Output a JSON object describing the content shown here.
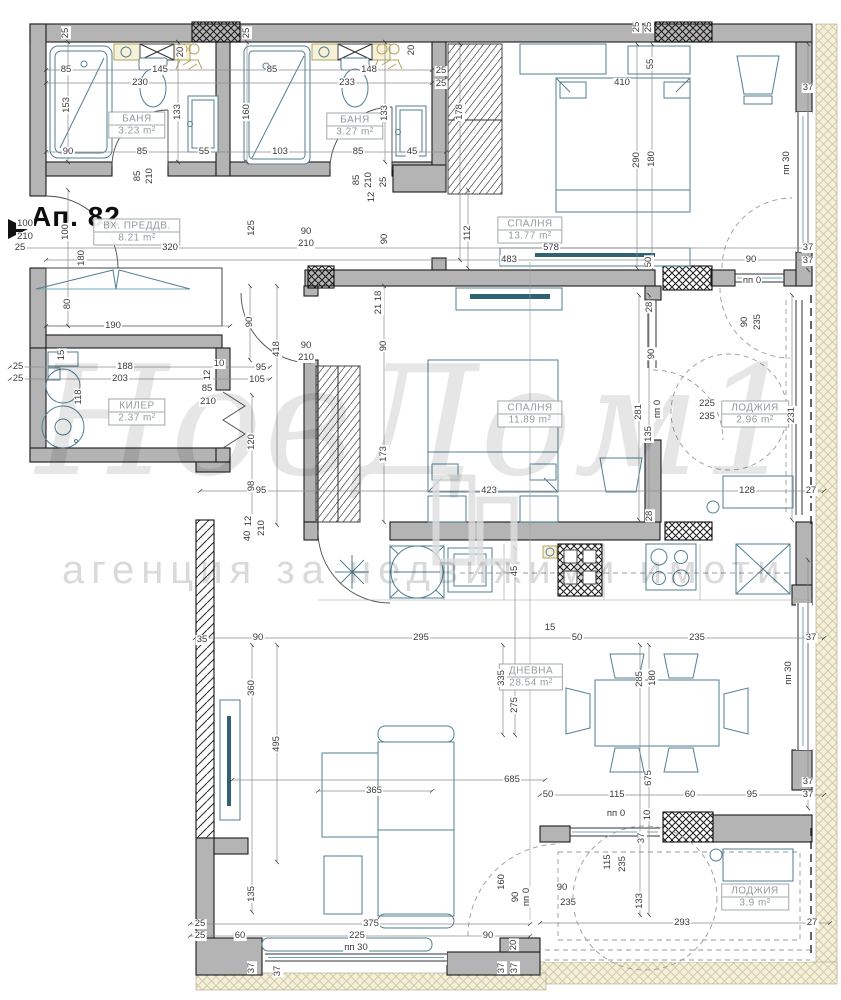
{
  "title": "Ап. 82",
  "watermark": {
    "line1": "НовДом1",
    "line2": "агенция за недвижими имоти"
  },
  "rooms": [
    {
      "name": "БАНЯ",
      "area": "3.23 m²",
      "x": 137,
      "y": 125
    },
    {
      "name": "БАНЯ",
      "area": "3.27 m²",
      "x": 355,
      "y": 126
    },
    {
      "name": "ВХ. ПРЕДДВ.",
      "area": "8.21 m²",
      "x": 137,
      "y": 232
    },
    {
      "name": "СПАЛНЯ",
      "area": "13.77 m²",
      "x": 530,
      "y": 230
    },
    {
      "name": "СПАЛНЯ",
      "area": "11.89 m²",
      "x": 530,
      "y": 414
    },
    {
      "name": "КИЛЕР",
      "area": "2.37 m²",
      "x": 137,
      "y": 412
    },
    {
      "name": "ЛОДЖИЯ",
      "area": "2.96 m²",
      "x": 755,
      "y": 414
    },
    {
      "name": "ДНЕВНА",
      "area": "28.54 m²",
      "x": 531,
      "y": 677
    },
    {
      "name": "ЛОДЖИЯ",
      "area": "3.9 m²",
      "x": 755,
      "y": 897
    }
  ],
  "dims": [
    {
      "t": "25",
      "x": 66,
      "y": 33,
      "r": 90
    },
    {
      "t": "20",
      "x": 181,
      "y": 52,
      "r": 90
    },
    {
      "t": "25",
      "x": 247,
      "y": 33,
      "r": 90
    },
    {
      "t": "20",
      "x": 412,
      "y": 50,
      "r": 90
    },
    {
      "t": "25",
      "x": 637,
      "y": 27,
      "r": 90
    },
    {
      "t": "25",
      "x": 649,
      "y": 27,
      "r": 90
    },
    {
      "t": "85",
      "x": 66,
      "y": 70,
      "r": 0
    },
    {
      "t": "145",
      "x": 160,
      "y": 70,
      "r": 0
    },
    {
      "t": "85",
      "x": 272,
      "y": 70,
      "r": 0
    },
    {
      "t": "148",
      "x": 369,
      "y": 70,
      "r": 0
    },
    {
      "t": "25",
      "x": 441,
      "y": 71,
      "r": 0
    },
    {
      "t": "25",
      "x": 441,
      "y": 84,
      "r": 0
    },
    {
      "t": "230",
      "x": 140,
      "y": 83,
      "r": 0
    },
    {
      "t": "233",
      "x": 347,
      "y": 83,
      "r": 0
    },
    {
      "t": "153",
      "x": 67,
      "y": 105,
      "r": 90
    },
    {
      "t": "133",
      "x": 178,
      "y": 112,
      "r": 90
    },
    {
      "t": "160",
      "x": 247,
      "y": 112,
      "r": 90
    },
    {
      "t": "133",
      "x": 385,
      "y": 113,
      "r": 90
    },
    {
      "t": "178",
      "x": 460,
      "y": 112,
      "r": 90
    },
    {
      "t": "90",
      "x": 68,
      "y": 152,
      "r": 0
    },
    {
      "t": "85",
      "x": 142,
      "y": 152,
      "r": 0
    },
    {
      "t": "55",
      "x": 204,
      "y": 152,
      "r": 0
    },
    {
      "t": "103",
      "x": 280,
      "y": 152,
      "r": 0
    },
    {
      "t": "85",
      "x": 358,
      "y": 152,
      "r": 0
    },
    {
      "t": "45",
      "x": 412,
      "y": 152,
      "r": 0
    },
    {
      "t": "85",
      "x": 138,
      "y": 176,
      "r": 90
    },
    {
      "t": "210",
      "x": 150,
      "y": 176,
      "r": 90
    },
    {
      "t": "85",
      "x": 357,
      "y": 180,
      "r": 90
    },
    {
      "t": "210",
      "x": 369,
      "y": 180,
      "r": 90
    },
    {
      "t": "25",
      "x": 384,
      "y": 182,
      "r": 90
    },
    {
      "t": "12",
      "x": 372,
      "y": 197,
      "r": 90
    },
    {
      "t": "410",
      "x": 622,
      "y": 83,
      "r": 0
    },
    {
      "t": "55",
      "x": 651,
      "y": 64,
      "r": 90
    },
    {
      "t": "290",
      "x": 637,
      "y": 160,
      "r": 90
    },
    {
      "t": "180",
      "x": 652,
      "y": 159,
      "r": 90
    },
    {
      "t": "112",
      "x": 468,
      "y": 233,
      "r": 90
    },
    {
      "t": "578",
      "x": 551,
      "y": 248,
      "r": 0
    },
    {
      "t": "483",
      "x": 509,
      "y": 260,
      "r": 0
    },
    {
      "t": "90",
      "x": 751,
      "y": 260,
      "r": 0
    },
    {
      "t": "37",
      "x": 808,
      "y": 88,
      "r": 0
    },
    {
      "t": "37",
      "x": 808,
      "y": 248,
      "r": 0
    },
    {
      "t": "37",
      "x": 808,
      "y": 261,
      "r": 0
    },
    {
      "t": "пп 30",
      "x": 787,
      "y": 163,
      "r": 90
    },
    {
      "t": "пп 0",
      "x": 752,
      "y": 281,
      "r": 0
    },
    {
      "t": "100",
      "x": 25,
      "y": 224,
      "r": 0
    },
    {
      "t": "210",
      "x": 25,
      "y": 237,
      "r": 0
    },
    {
      "t": "25",
      "x": 20,
      "y": 248,
      "r": 0
    },
    {
      "t": "100",
      "x": 66,
      "y": 232,
      "r": 90
    },
    {
      "t": "180",
      "x": 82,
      "y": 258,
      "r": 90
    },
    {
      "t": "320",
      "x": 170,
      "y": 248,
      "r": 0
    },
    {
      "t": "125",
      "x": 252,
      "y": 228,
      "r": 90
    },
    {
      "t": "90",
      "x": 306,
      "y": 232,
      "r": 0
    },
    {
      "t": "210",
      "x": 306,
      "y": 244,
      "r": 0
    },
    {
      "t": "90",
      "x": 385,
      "y": 239,
      "r": 90
    },
    {
      "t": "18",
      "x": 379,
      "y": 296,
      "r": 90
    },
    {
      "t": "21",
      "x": 379,
      "y": 309,
      "r": 90
    },
    {
      "t": "80",
      "x": 68,
      "y": 304,
      "r": 90
    },
    {
      "t": "190",
      "x": 113,
      "y": 326,
      "r": 0
    },
    {
      "t": "90",
      "x": 250,
      "y": 322,
      "r": 90
    },
    {
      "t": "15",
      "x": 62,
      "y": 355,
      "r": 90
    },
    {
      "t": "25",
      "x": 18,
      "y": 367,
      "r": 0
    },
    {
      "t": "188",
      "x": 125,
      "y": 367,
      "r": 0
    },
    {
      "t": "95",
      "x": 261,
      "y": 368,
      "r": 0
    },
    {
      "t": "25",
      "x": 18,
      "y": 379,
      "r": 0
    },
    {
      "t": "203",
      "x": 120,
      "y": 379,
      "r": 0
    },
    {
      "t": "105",
      "x": 257,
      "y": 380,
      "r": 0
    },
    {
      "t": "118",
      "x": 79,
      "y": 397,
      "r": 90
    },
    {
      "t": "10",
      "x": 219,
      "y": 364,
      "r": 0
    },
    {
      "t": "12",
      "x": 208,
      "y": 375,
      "r": 90
    },
    {
      "t": "85",
      "x": 207,
      "y": 389,
      "r": 0
    },
    {
      "t": "210",
      "x": 208,
      "y": 402,
      "r": 0
    },
    {
      "t": "418",
      "x": 277,
      "y": 349,
      "r": 90
    },
    {
      "t": "90",
      "x": 306,
      "y": 346,
      "r": 0
    },
    {
      "t": "210",
      "x": 306,
      "y": 358,
      "r": 0
    },
    {
      "t": "90",
      "x": 384,
      "y": 346,
      "r": 90
    },
    {
      "t": "173",
      "x": 384,
      "y": 454,
      "r": 90
    },
    {
      "t": "120",
      "x": 252,
      "y": 442,
      "r": 90
    },
    {
      "t": "98",
      "x": 252,
      "y": 486,
      "r": 90
    },
    {
      "t": "95",
      "x": 261,
      "y": 491,
      "r": 0
    },
    {
      "t": "12",
      "x": 249,
      "y": 521,
      "r": 90
    },
    {
      "t": "210",
      "x": 262,
      "y": 528,
      "r": 90
    },
    {
      "t": "40",
      "x": 248,
      "y": 536,
      "r": 90
    },
    {
      "t": "423",
      "x": 489,
      "y": 491,
      "r": 0
    },
    {
      "t": "128",
      "x": 747,
      "y": 491,
      "r": 0
    },
    {
      "t": "27",
      "x": 811,
      "y": 491,
      "r": 0
    },
    {
      "t": "281",
      "x": 639,
      "y": 412,
      "r": 90
    },
    {
      "t": "пп 0",
      "x": 658,
      "y": 409,
      "r": 90
    },
    {
      "t": "225",
      "x": 707,
      "y": 404,
      "r": 0
    },
    {
      "t": "235",
      "x": 707,
      "y": 417,
      "r": 0
    },
    {
      "t": "135",
      "x": 649,
      "y": 434,
      "r": 90
    },
    {
      "t": "231",
      "x": 792,
      "y": 415,
      "r": 90
    },
    {
      "t": "28",
      "x": 650,
      "y": 307,
      "r": 90
    },
    {
      "t": "90",
      "x": 652,
      "y": 354,
      "r": 90
    },
    {
      "t": "50",
      "x": 649,
      "y": 262,
      "r": 90
    },
    {
      "t": "90",
      "x": 745,
      "y": 322,
      "r": 90
    },
    {
      "t": "235",
      "x": 758,
      "y": 322,
      "r": 90
    },
    {
      "t": "28",
      "x": 650,
      "y": 516,
      "r": 90
    },
    {
      "t": "45",
      "x": 515,
      "y": 571,
      "r": 90
    },
    {
      "t": "15",
      "x": 550,
      "y": 628,
      "r": 0
    },
    {
      "t": "50",
      "x": 577,
      "y": 638,
      "r": 0
    },
    {
      "t": "295",
      "x": 421,
      "y": 638,
      "r": 0
    },
    {
      "t": "235",
      "x": 697,
      "y": 638,
      "r": 0
    },
    {
      "t": "37",
      "x": 811,
      "y": 638,
      "r": 0
    },
    {
      "t": "90",
      "x": 258,
      "y": 638,
      "r": 0
    },
    {
      "t": "35",
      "x": 202,
      "y": 640,
      "r": 0
    },
    {
      "t": "360",
      "x": 252,
      "y": 688,
      "r": 90
    },
    {
      "t": "495",
      "x": 277,
      "y": 744,
      "r": 90
    },
    {
      "t": "135",
      "x": 252,
      "y": 894,
      "r": 90
    },
    {
      "t": "335",
      "x": 502,
      "y": 678,
      "r": 90
    },
    {
      "t": "275",
      "x": 515,
      "y": 705,
      "r": 90
    },
    {
      "t": "285",
      "x": 640,
      "y": 679,
      "r": 90
    },
    {
      "t": "180",
      "x": 653,
      "y": 678,
      "r": 90
    },
    {
      "t": "пп 30",
      "x": 789,
      "y": 673,
      "r": 90
    },
    {
      "t": "685",
      "x": 512,
      "y": 780,
      "r": 0
    },
    {
      "t": "365",
      "x": 374,
      "y": 791,
      "r": 0
    },
    {
      "t": "675",
      "x": 649,
      "y": 778,
      "r": 90
    },
    {
      "t": "50",
      "x": 548,
      "y": 795,
      "r": 0
    },
    {
      "t": "115",
      "x": 617,
      "y": 795,
      "r": 0
    },
    {
      "t": "60",
      "x": 690,
      "y": 795,
      "r": 0
    },
    {
      "t": "95",
      "x": 752,
      "y": 795,
      "r": 0
    },
    {
      "t": "37",
      "x": 808,
      "y": 782,
      "r": 0
    },
    {
      "t": "37",
      "x": 808,
      "y": 795,
      "r": 0
    },
    {
      "t": "160",
      "x": 502,
      "y": 882,
      "r": 90
    },
    {
      "t": "90",
      "x": 516,
      "y": 897,
      "r": 90
    },
    {
      "t": "пп 0",
      "x": 527,
      "y": 897,
      "r": 90
    },
    {
      "t": "20",
      "x": 514,
      "y": 945,
      "r": 90
    },
    {
      "t": "пп 0",
      "x": 616,
      "y": 814,
      "r": 0
    },
    {
      "t": "10",
      "x": 648,
      "y": 815,
      "r": 90
    },
    {
      "t": "37",
      "x": 642,
      "y": 838,
      "r": 90
    },
    {
      "t": "115",
      "x": 608,
      "y": 862,
      "r": 90
    },
    {
      "t": "235",
      "x": 623,
      "y": 864,
      "r": 90
    },
    {
      "t": "90",
      "x": 562,
      "y": 888,
      "r": 0
    },
    {
      "t": "235",
      "x": 568,
      "y": 903,
      "r": 0
    },
    {
      "t": "133",
      "x": 640,
      "y": 901,
      "r": 90
    },
    {
      "t": "293",
      "x": 682,
      "y": 923,
      "r": 0
    },
    {
      "t": "27",
      "x": 812,
      "y": 923,
      "r": 0
    },
    {
      "t": "25",
      "x": 200,
      "y": 924,
      "r": 0
    },
    {
      "t": "25",
      "x": 200,
      "y": 936,
      "r": 0
    },
    {
      "t": "60",
      "x": 240,
      "y": 936,
      "r": 0
    },
    {
      "t": "375",
      "x": 371,
      "y": 924,
      "r": 0
    },
    {
      "t": "225",
      "x": 357,
      "y": 936,
      "r": 0
    },
    {
      "t": "пп 30",
      "x": 356,
      "y": 948,
      "r": 0
    },
    {
      "t": "90",
      "x": 488,
      "y": 936,
      "r": 0
    },
    {
      "t": "37",
      "x": 252,
      "y": 968,
      "r": 90
    },
    {
      "t": "37",
      "x": 278,
      "y": 971,
      "r": 90
    },
    {
      "t": "37",
      "x": 502,
      "y": 968,
      "r": 90
    },
    {
      "t": "37",
      "x": 515,
      "y": 968,
      "r": 90
    }
  ],
  "colors": {
    "wall": "#b4b4b4",
    "furniture_line": "#527f92",
    "sanitary_accent": "#b3a45c",
    "dim_text": "#3a3a3a",
    "room_label_text": "#8f9b9b",
    "watermark": "#d7d7d7"
  }
}
